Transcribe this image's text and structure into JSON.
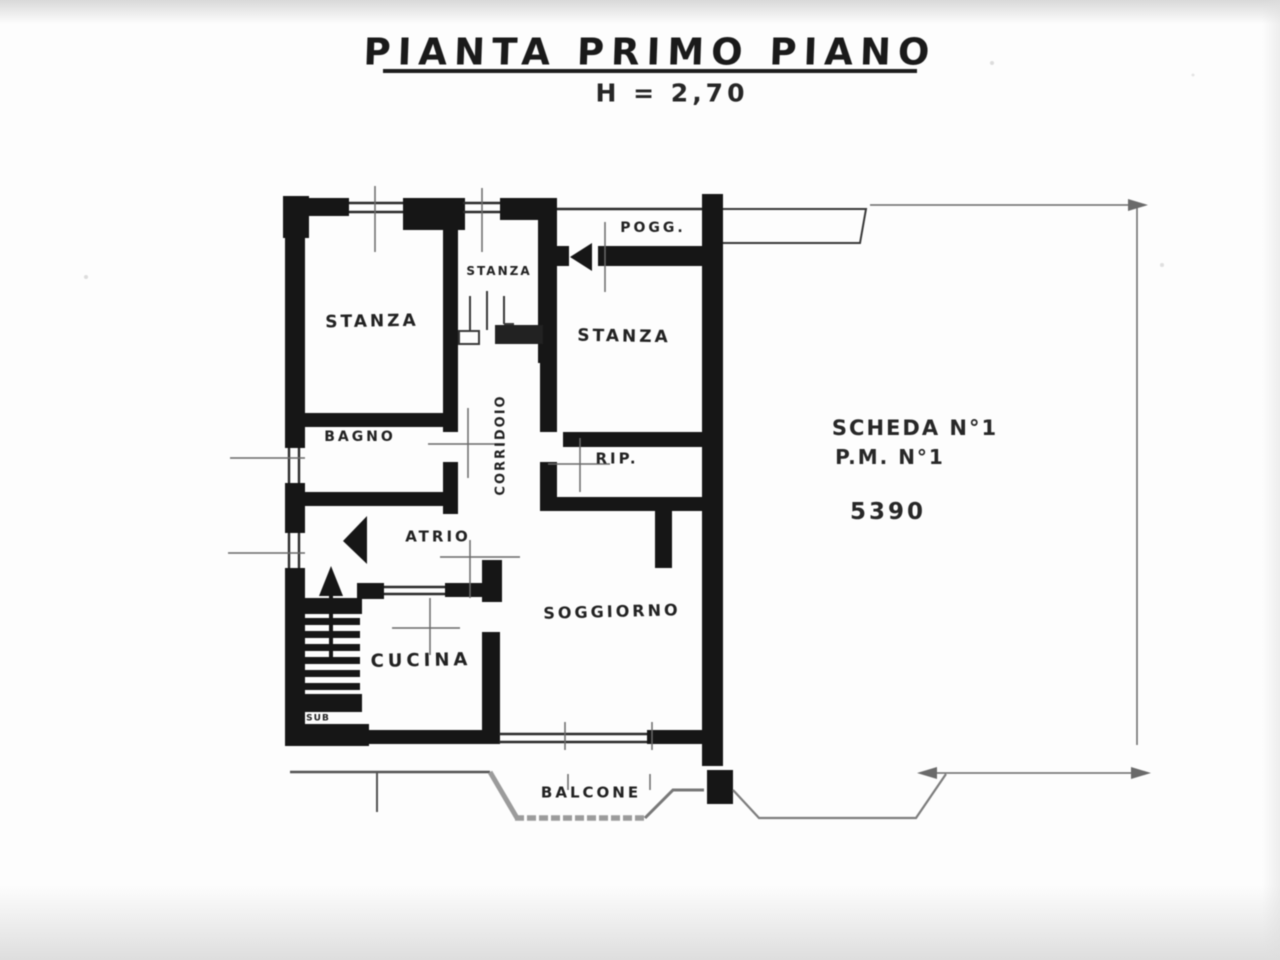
{
  "title": {
    "main": "PIANTA PRIMO PIANO",
    "height_note": "H = 2,70"
  },
  "rooms": {
    "stanza_left": {
      "label": "STANZA"
    },
    "stanza_small": {
      "label": "STANZA"
    },
    "stanza_right": {
      "label": "STANZA"
    },
    "pogg": {
      "label": "POGG."
    },
    "bagno": {
      "label": "BAGNO"
    },
    "corridoio": {
      "label": "CORRIDOIO"
    },
    "rip": {
      "label": "RIP."
    },
    "atrio": {
      "label": "ATRIO"
    },
    "cucina": {
      "label": "CUCINA"
    },
    "soggiorno": {
      "label": "SOGGIORNO"
    },
    "balcone": {
      "label": "BALCONE"
    },
    "sub": {
      "label": "SUB"
    }
  },
  "annotations": {
    "scheda": "SCHEDA N°1",
    "pm": "P.M. N°1",
    "code": "5390"
  },
  "colors": {
    "wall": "#1b1b1b",
    "thin_line": "#3c3c3c",
    "dimension_line": "#6b6b6b",
    "balcony_line": "#909090",
    "paper": "#fdfdfd"
  }
}
